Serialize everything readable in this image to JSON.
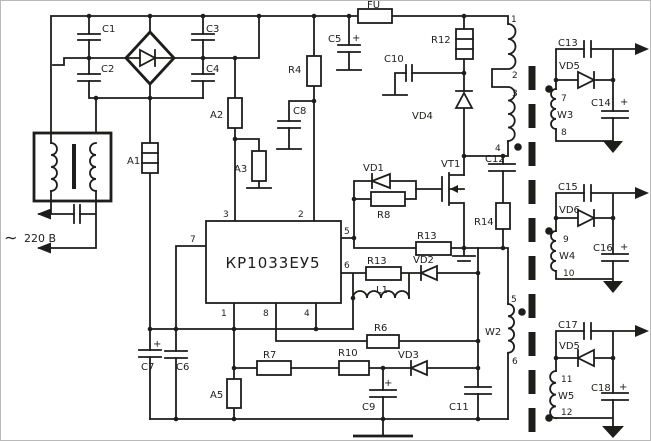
{
  "mains": {
    "ac_symbol": "∼",
    "voltage": "220 В"
  },
  "fuse": {
    "fu": "FU"
  },
  "capacitors": {
    "c1": "C1",
    "c2": "C2",
    "c3": "C3",
    "c4": "C4",
    "c5": "C5",
    "c6": "C6",
    "c7": "C7",
    "c8": "C8",
    "c9": "C9",
    "c10": "C10",
    "c11": "C11",
    "c12": "C12",
    "c13": "C13",
    "c14": "C14",
    "c15": "C15",
    "c16": "C16",
    "c17": "C17",
    "c18": "C18"
  },
  "resistors": {
    "r4": "R4",
    "r6": "R6",
    "r7": "R7",
    "r8": "R8",
    "r10": "R10",
    "r12": "R12",
    "r13_gate": "R13",
    "r13_filter": "R13",
    "r14": "R14"
  },
  "fusible": {
    "a1": "A1",
    "a2": "A2",
    "a3": "A3",
    "a5": "A5"
  },
  "inductors": {
    "l1": "L1"
  },
  "diodes": {
    "vd1": "VD1",
    "vd2": "VD2",
    "vd3": "VD3",
    "vd4": "VD4",
    "vd5": "VD5",
    "vd6": "VD6",
    "vd7_printed": "VD5"
  },
  "transistor": {
    "vt1": "VT1"
  },
  "ic": {
    "part": "КР1033ЕУ5",
    "p1": "1",
    "p2": "2",
    "p3": "3",
    "p4": "4",
    "p5": "5",
    "p6": "6",
    "p7": "7",
    "p8": "8"
  },
  "transformer": {
    "w2": "W2",
    "w3": "W3",
    "w4": "W4",
    "w5": "W5",
    "p1": "1",
    "p2": "2",
    "p3": "3",
    "p4": "4",
    "p5": "5",
    "p6": "6",
    "p7": "7",
    "p8": "8",
    "p9": "9",
    "p10": "10",
    "p11": "11",
    "p12": "12"
  },
  "marks": {
    "plus": "+"
  }
}
